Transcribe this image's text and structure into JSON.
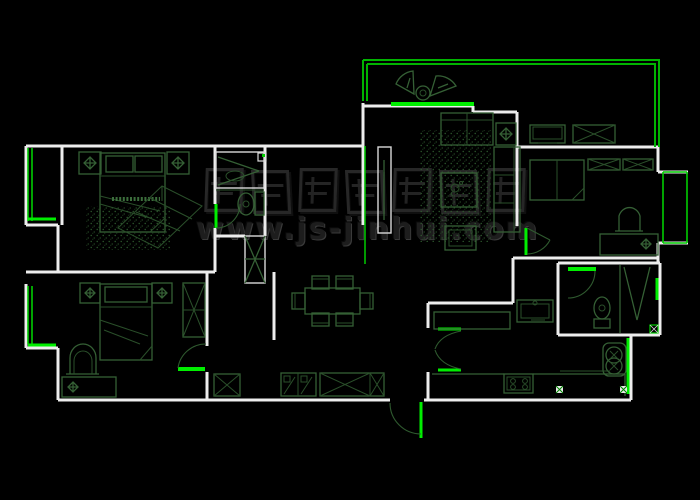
{
  "title": "apartment-floor-plan-cad-drawing",
  "watermark": {
    "url": "www.js-jinhui.com"
  },
  "palette": {
    "background": "#000000",
    "wall": "#ededed",
    "window_green": "#00ee00",
    "balcony_green": "#00b400",
    "furniture_green": "#356035",
    "furniture_dark_green": "#2a4f2a",
    "watermark_gray": "#2c2c2c"
  },
  "drawing": {
    "type": "floor-plan",
    "rooms": [
      {
        "name": "master-bedroom"
      },
      {
        "name": "master-bathroom"
      },
      {
        "name": "wardrobe-closet"
      },
      {
        "name": "second-bedroom"
      },
      {
        "name": "hallway"
      },
      {
        "name": "dining-area"
      },
      {
        "name": "living-room"
      },
      {
        "name": "balcony"
      },
      {
        "name": "study-bedroom"
      },
      {
        "name": "bathroom"
      },
      {
        "name": "kitchen"
      },
      {
        "name": "utility-nook"
      },
      {
        "name": "entry"
      }
    ],
    "furniture_icons": [
      "double-bed-icon",
      "pillow-icon",
      "nightstand-icon",
      "table-lamp-icon",
      "rug-icon",
      "perspective-sketch-icon",
      "vanity-counter-icon",
      "toilet-icon",
      "shower-head-icon",
      "tall-wardrobe-icon",
      "single-bed-icon",
      "desk-icon",
      "chair-icon",
      "shoe-cabinet-icon",
      "sideboard-icon",
      "dining-table-icon",
      "dining-chair-icon",
      "sofa-icon",
      "coffee-table-icon",
      "tv-console-icon",
      "tv-icon",
      "side-table-icon",
      "stool-icon",
      "balcony-chair-icon",
      "balcony-table-icon",
      "cabinet-icon",
      "washing-machine-icon",
      "sink-icon",
      "stove-icon",
      "kitchen-counter-icon",
      "door-swing-icon",
      "floor-drain-icon",
      "bay-window-icon"
    ]
  }
}
